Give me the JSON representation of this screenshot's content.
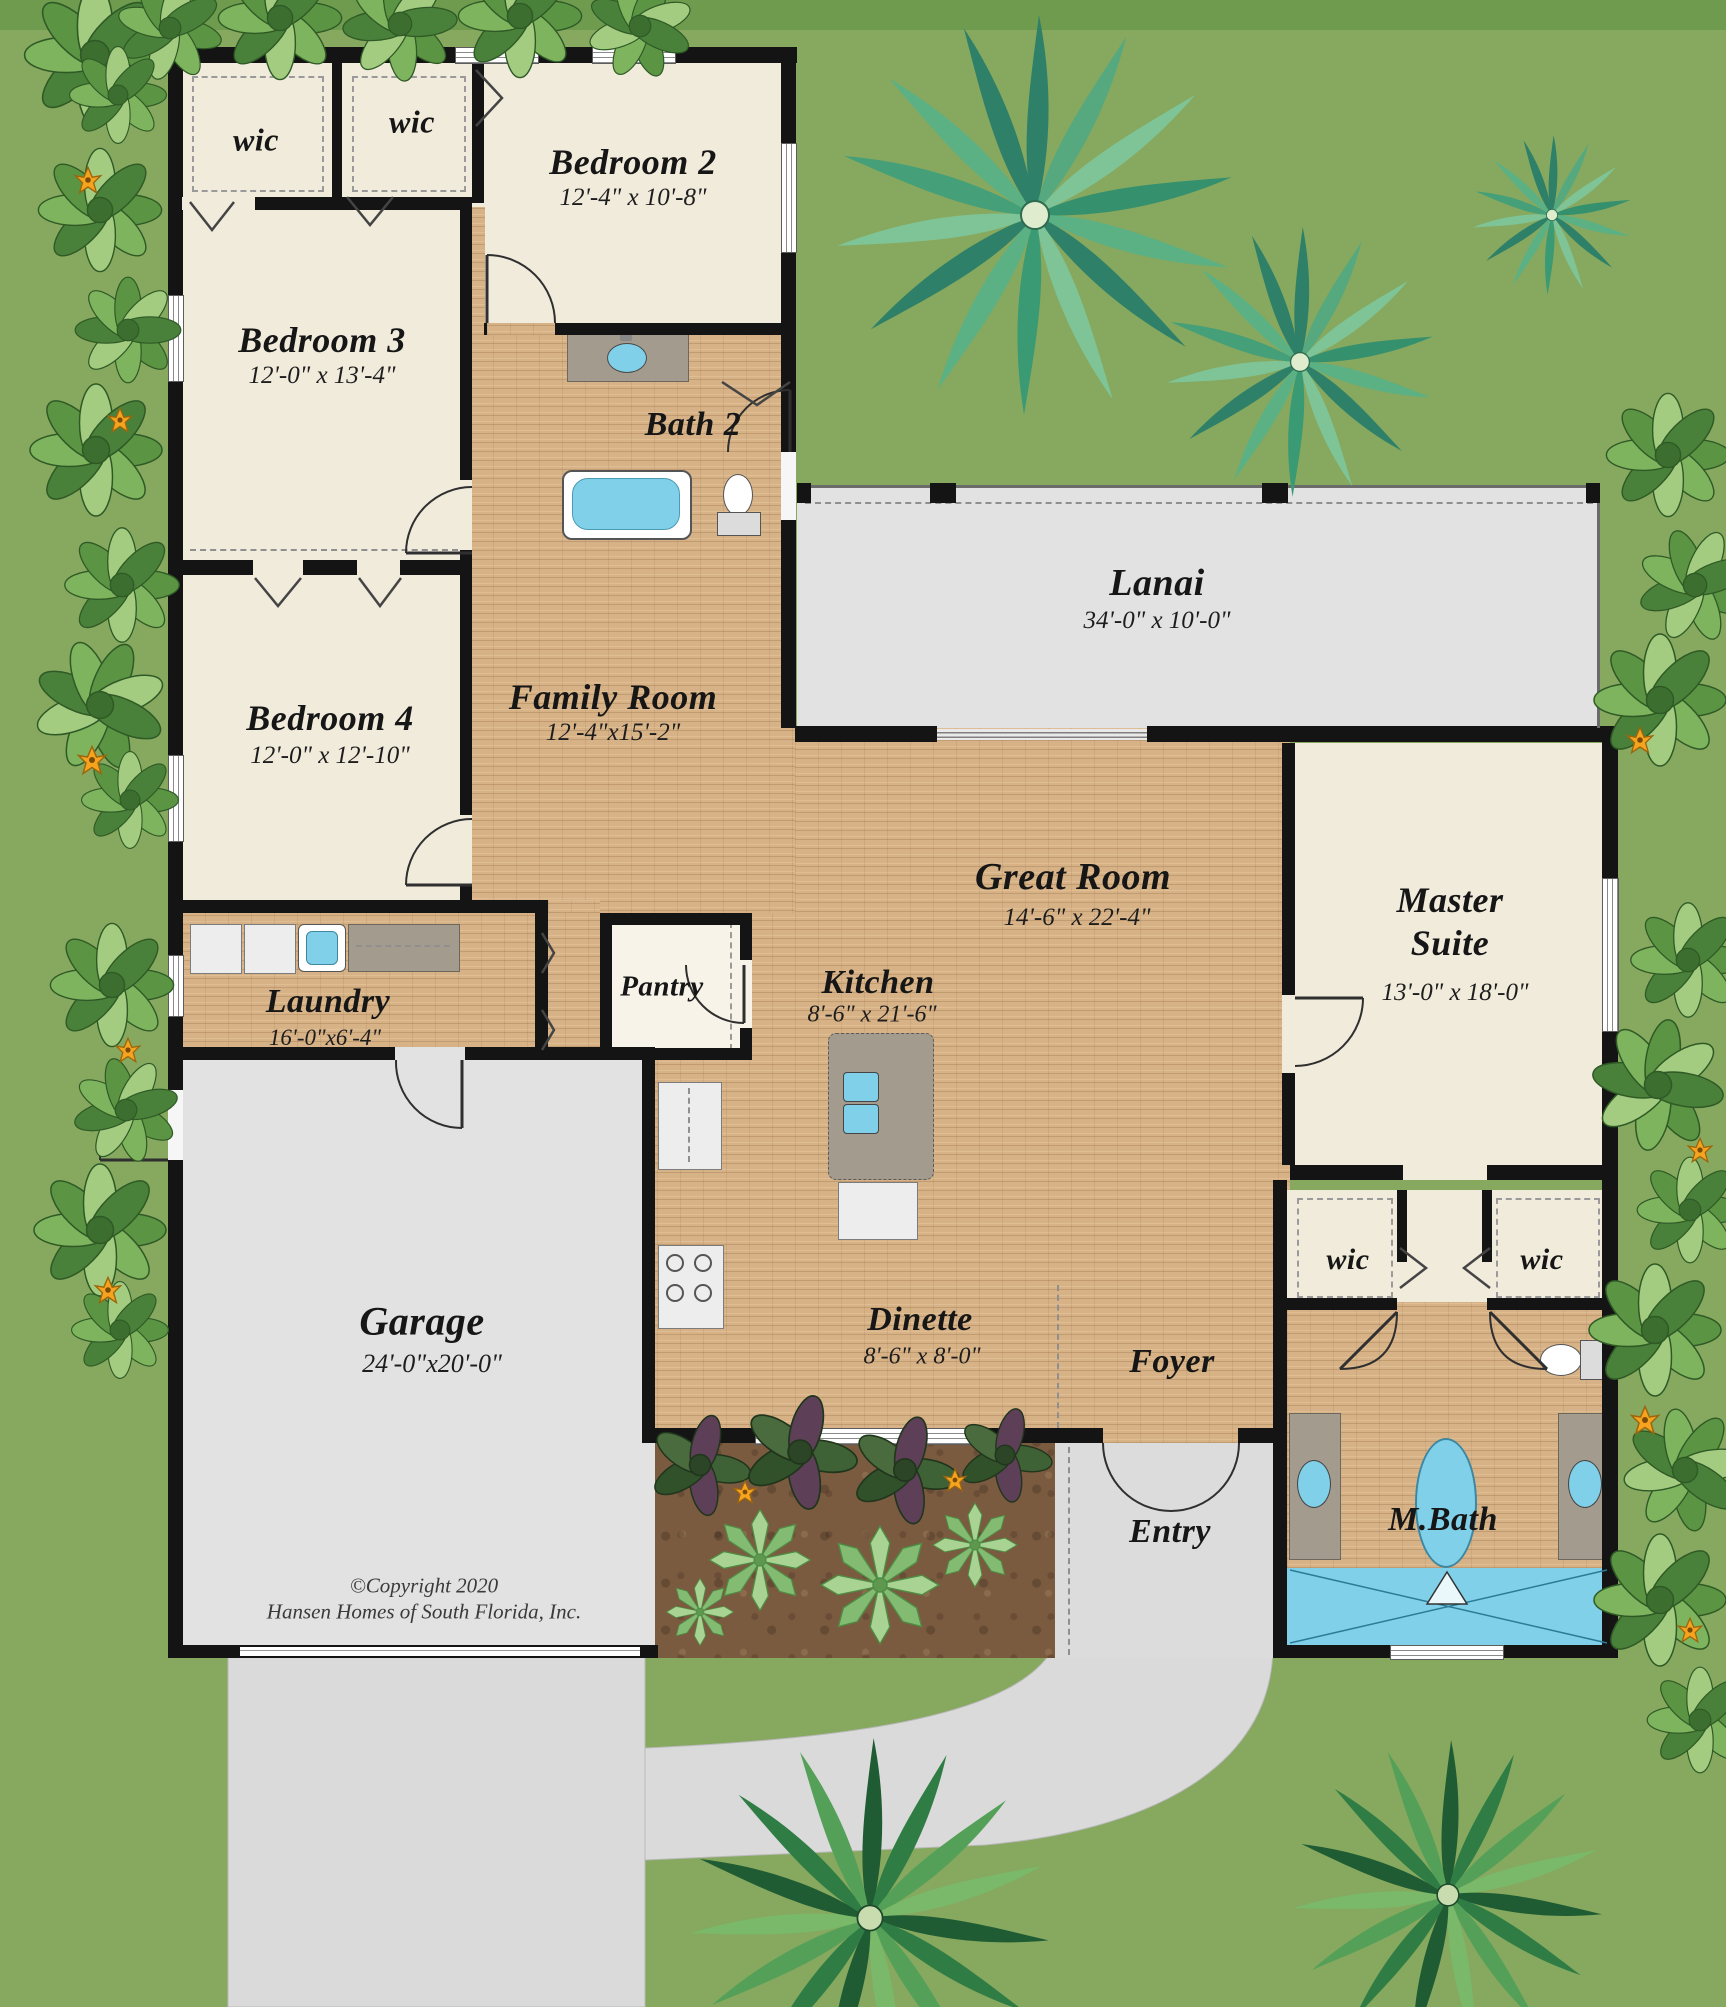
{
  "rooms": {
    "wic_bed3": {
      "label": "wic"
    },
    "wic_bed2": {
      "label": "wic"
    },
    "bedroom2": {
      "label": "Bedroom 2",
      "dims": "12'-4\" x 10'-8\""
    },
    "bedroom3": {
      "label": "Bedroom 3",
      "dims": "12'-0\" x 13'-4\""
    },
    "bath2": {
      "label": "Bath 2"
    },
    "bedroom4": {
      "label": "Bedroom 4",
      "dims": "12'-0\" x 12'-10\""
    },
    "family_room": {
      "label": "Family Room",
      "dims": "12'-4\"x15'-2\""
    },
    "lanai": {
      "label": "Lanai",
      "dims": "34'-0\" x 10'-0\""
    },
    "great_room": {
      "label": "Great Room",
      "dims": "14'-6\" x 22'-4\""
    },
    "master_suite": {
      "line1": "Master",
      "line2": "Suite",
      "dims": "13'-0\" x 18'-0\""
    },
    "kitchen": {
      "label": "Kitchen",
      "dims": "8'-6\" x 21'-6\""
    },
    "pantry": {
      "label": "Pantry"
    },
    "laundry": {
      "label": "Laundry",
      "dims": "16'-0\"x6'-4\""
    },
    "garage": {
      "label": "Garage",
      "dims": "24'-0\"x20'-0\""
    },
    "dinette": {
      "label": "Dinette",
      "dims": "8'-6\" x 8'-0\""
    },
    "foyer": {
      "label": "Foyer"
    },
    "entry": {
      "label": "Entry"
    },
    "wic_master_left": {
      "label": "wic"
    },
    "wic_master_right": {
      "label": "wic"
    },
    "master_bath": {
      "label": "M.Bath"
    }
  },
  "copyright": {
    "line1": "©Copyright 2020",
    "line2": "Hansen Homes of South Florida, Inc."
  },
  "colors": {
    "grass": "#86a85f",
    "tile_floor": "#d7b287",
    "room_floor": "#f1ebdc",
    "wall": "#141414",
    "concrete": "#dcdcdc",
    "lanai_floor": "#e2e2e2",
    "water_fixture": "#7fd0e8",
    "mulch": "#7b5b3f",
    "flower_accent": "#f6a41f"
  }
}
